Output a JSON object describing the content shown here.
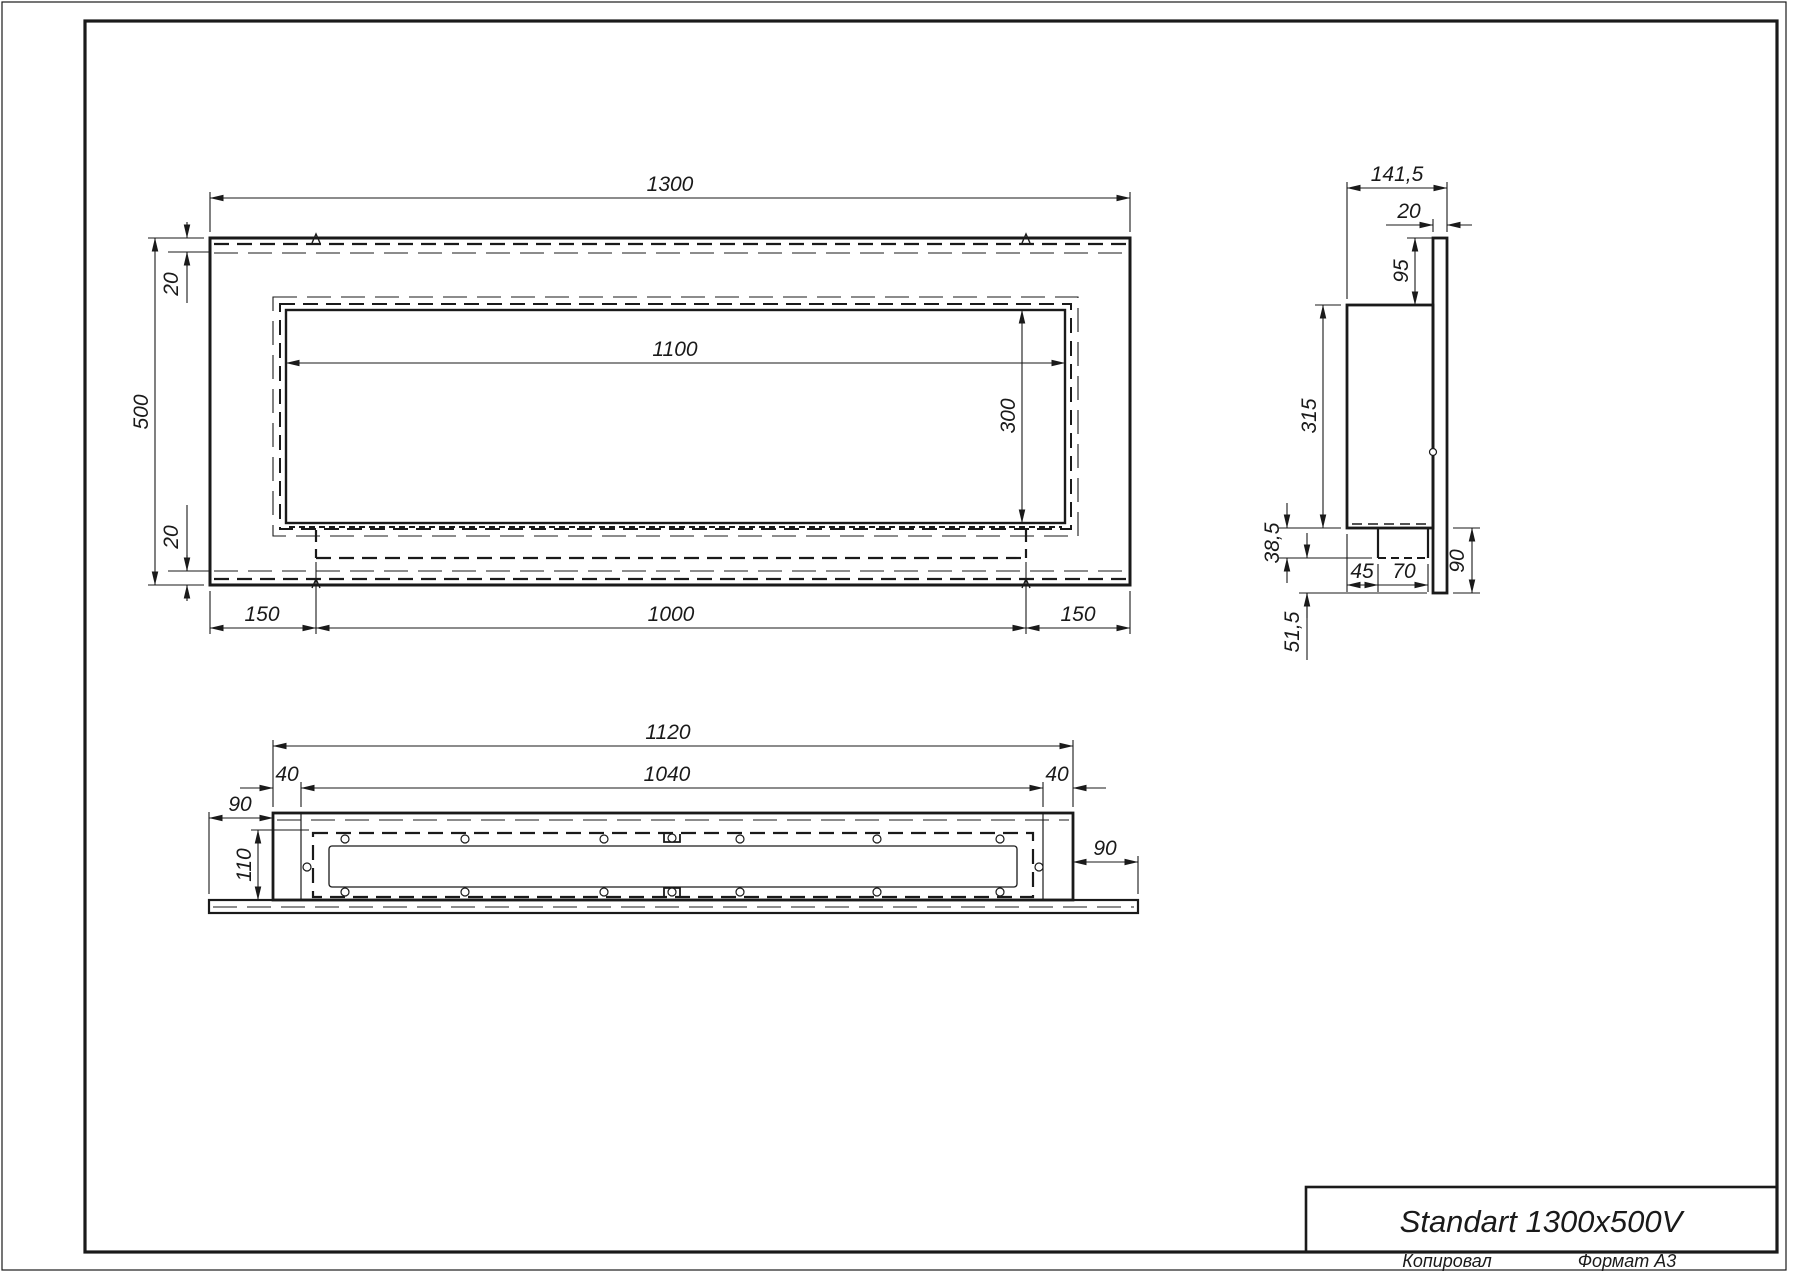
{
  "title_block": {
    "title": "Standart 1300x500V"
  },
  "footer": {
    "copied": "Копировал",
    "format": "Формат А3"
  },
  "ink_color": "#1a1a1a",
  "dims": {
    "front": {
      "width": "1300",
      "height": "500",
      "top_inset": "20",
      "bottom_inset": "20",
      "opening_width": "1100",
      "opening_height": "300",
      "left_margin": "150",
      "burner_width": "1000",
      "right_margin": "150"
    },
    "side": {
      "depth": "141,5",
      "panel_thickness": "20",
      "top_gap": "95",
      "body_height": "315",
      "tray_height": "38,5",
      "tray_offset": "45",
      "tray_width": "70",
      "flange": "90",
      "tail": "51,5"
    },
    "bottom": {
      "outer_width": "1120",
      "inner_width": "1040",
      "left_wall": "40",
      "right_wall": "40",
      "left_flange": "90",
      "right_flange": "90",
      "depth": "110"
    }
  }
}
